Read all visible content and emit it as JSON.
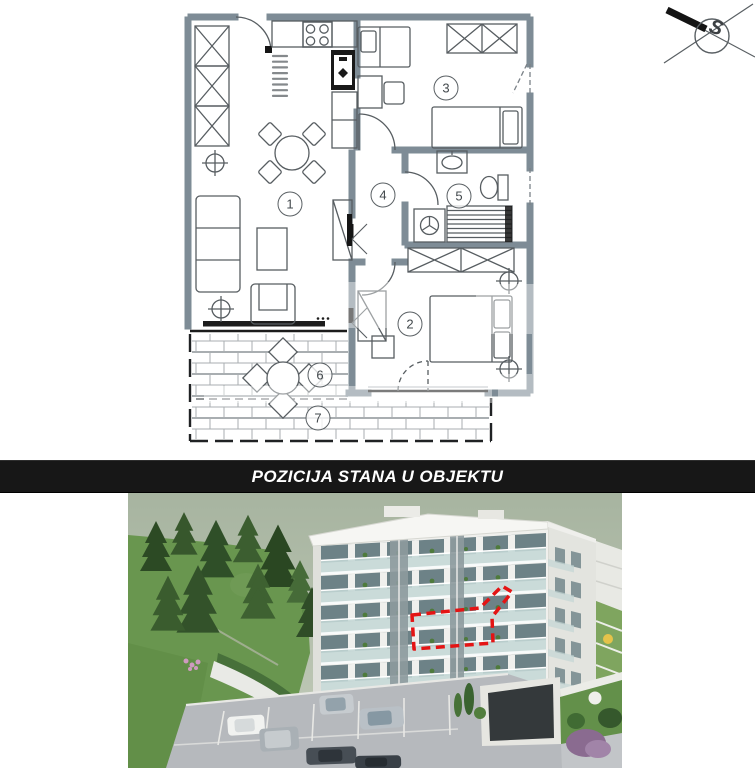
{
  "banner": {
    "title": "POZICIJA STANA U OBJEKTU"
  },
  "compass": {
    "label": "S"
  },
  "floor_plan": {
    "rooms": [
      {
        "number": "1",
        "name": "living-dining-kitchen",
        "x": 290,
        "y": 204
      },
      {
        "number": "2",
        "name": "bedroom-main",
        "x": 410,
        "y": 324
      },
      {
        "number": "3",
        "name": "bedroom-second",
        "x": 446,
        "y": 88
      },
      {
        "number": "4",
        "name": "hall",
        "x": 383,
        "y": 195
      },
      {
        "number": "5",
        "name": "bathroom",
        "x": 459,
        "y": 196
      },
      {
        "number": "6",
        "name": "terrace-upper",
        "x": 320,
        "y": 375
      },
      {
        "number": "7",
        "name": "terrace-lower",
        "x": 318,
        "y": 418
      }
    ]
  },
  "position_render": {
    "marker_meaning": "apartment position outline"
  },
  "colors": {
    "wall": "#7e8c96",
    "plan-line": "#575d61",
    "plan-dark": "#151515",
    "banner-bg": "#171717",
    "banner-text": "#ffffff",
    "marker": "#e41414",
    "sky": "#a7b4a0",
    "sky-light": "#c3ccba",
    "grass": "#69964f",
    "grass-dark": "#4d7a3a",
    "building": "#f0f0ed",
    "building-shade": "#dfe0db",
    "glass": "#c4d7d6",
    "window": "#6d8287",
    "paving": "#b6b9bd",
    "hedge": "#4e7a3c",
    "garage": "#34393b"
  }
}
